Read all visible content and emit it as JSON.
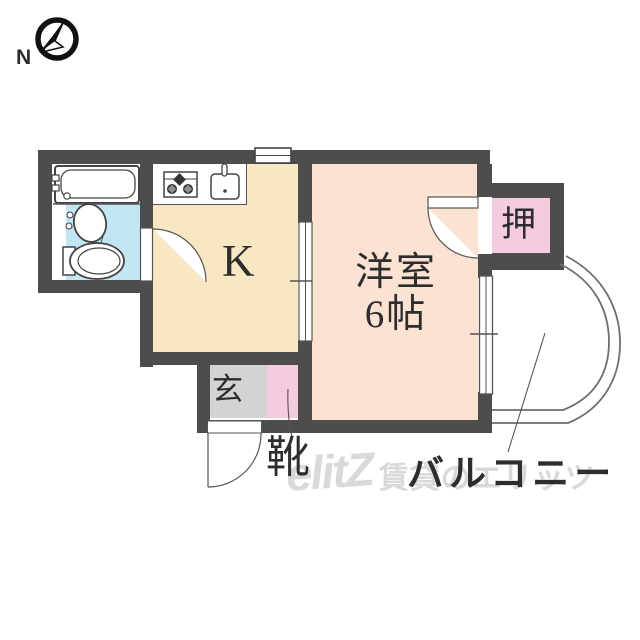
{
  "compass": {
    "label": "N"
  },
  "labels": {
    "kitchen": "K",
    "room_name": "洋室",
    "room_size": "6帖",
    "closet": "押",
    "entrance": "玄",
    "shoes": "靴",
    "balcony": "バルコニー"
  },
  "watermark": {
    "logo": "elitZ",
    "caption": "賃貸のエリッツ"
  },
  "colors": {
    "wall": "#4d4d4d",
    "kitchen": "#f8e7c3",
    "western_room": "#fbe2d3",
    "closet_pink": "#f5cbdf",
    "entrance_gray": "#d3d3d3",
    "bathroom_blue": "#c3e6f4",
    "line": "#4a4a4a",
    "balcony_line": "#6f6f6f"
  },
  "fixtures": [
    "bathtub",
    "washbasin",
    "toilet",
    "gas-stove",
    "kitchen-sink"
  ]
}
